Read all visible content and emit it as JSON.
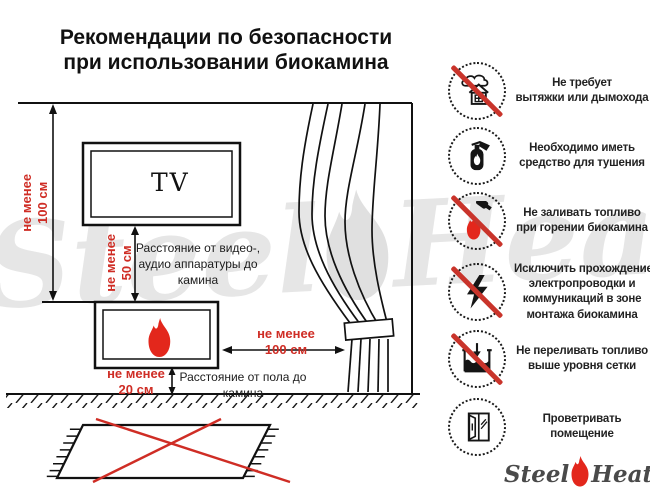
{
  "title": {
    "lines": [
      "Рекомендации по безопасности",
      "при использовании биокамина"
    ]
  },
  "diagram": {
    "tv_label": "TV",
    "height_above_fireplace": {
      "lines": [
        "не менее",
        "100 см"
      ]
    },
    "tv_to_fireplace": {
      "lines": [
        "не менее",
        "50 см"
      ]
    },
    "tv_to_fireplace_desc": {
      "lines": [
        "Расстояние от видео-,",
        "аудио аппаратуры до",
        "камина"
      ]
    },
    "fireplace_to_curtain": {
      "lines": [
        "не менее",
        "100 см"
      ]
    },
    "floor_to_fireplace": {
      "lines": [
        "не менее",
        "20 см"
      ]
    },
    "floor_to_fireplace_desc": {
      "lines": [
        "Расстояние от пола до",
        "камина"
      ]
    }
  },
  "rules": [
    {
      "icon": "no-chimney-icon",
      "crossed": true,
      "lines": [
        "Не требует",
        "вытяжки или дымохода"
      ]
    },
    {
      "icon": "extinguisher-icon",
      "crossed": false,
      "lines": [
        "Необходимо иметь",
        "средство для тушения"
      ]
    },
    {
      "icon": "no-refuel-while-burning-icon",
      "crossed": true,
      "lines": [
        "Не заливать топливо",
        "при горении биокамина"
      ]
    },
    {
      "icon": "no-electrical-wiring-icon",
      "crossed": true,
      "lines": [
        "Исключить прохождение",
        "электропроводки и",
        "коммуникаций в зоне",
        "монтажа биокамина"
      ]
    },
    {
      "icon": "no-overfill-icon",
      "crossed": true,
      "lines": [
        "Не переливать топливо",
        "выше уровня сетки"
      ]
    },
    {
      "icon": "ventilate-icon",
      "crossed": false,
      "lines": [
        "Проветривать",
        "помещение"
      ]
    }
  ],
  "logo": {
    "steel": "Steel",
    "heat": "Heat"
  },
  "watermark": {
    "steel": "Steel",
    "heat": "Heat"
  },
  "colors": {
    "accent_red": "#cf2d25",
    "ink": "#1c1c1c",
    "watermark_gray": "#e6e6e6",
    "logo_gray": "#4a4a4a"
  }
}
